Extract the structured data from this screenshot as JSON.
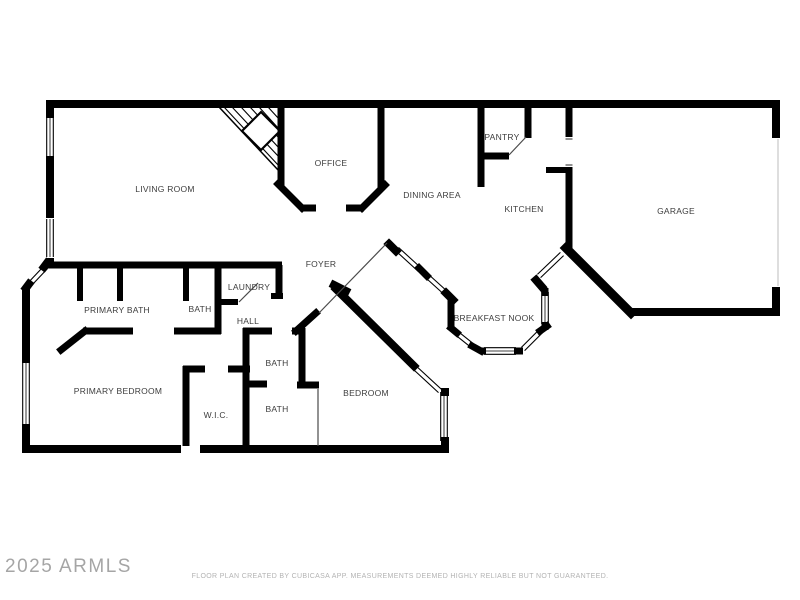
{
  "page": {
    "background": "#ffffff"
  },
  "colors": {
    "walls": "#000000",
    "labels": "#3d3d3d",
    "watermark": "#9c9c9c",
    "footer": "#b3b3b3"
  },
  "watermark": {
    "text": "2025 ARMLS"
  },
  "footer": {
    "text": "FLOOR PLAN CREATED BY CUBICASA APP. MEASUREMENTS DEEMED HIGHLY RELIABLE BUT NOT GUARANTEED."
  },
  "floor_plan": {
    "rooms": [
      {
        "id": "living-room",
        "label": "LIVING ROOM",
        "x": 165,
        "y": 189
      },
      {
        "id": "office",
        "label": "OFFICE",
        "x": 331,
        "y": 163
      },
      {
        "id": "pantry",
        "label": "PANTRY",
        "x": 502,
        "y": 137
      },
      {
        "id": "dining-area",
        "label": "DINING AREA",
        "x": 432,
        "y": 195
      },
      {
        "id": "kitchen",
        "label": "KITCHEN",
        "x": 524,
        "y": 209
      },
      {
        "id": "garage",
        "label": "GARAGE",
        "x": 676,
        "y": 211
      },
      {
        "id": "foyer",
        "label": "FOYER",
        "x": 321,
        "y": 264
      },
      {
        "id": "laundry",
        "label": "LAUNDRY",
        "x": 249,
        "y": 287
      },
      {
        "id": "primary-bath",
        "label": "PRIMARY BATH",
        "x": 117,
        "y": 310
      },
      {
        "id": "bath-middle",
        "label": "BATH",
        "x": 200,
        "y": 309
      },
      {
        "id": "hall",
        "label": "HALL",
        "x": 248,
        "y": 321
      },
      {
        "id": "breakfast-nook",
        "label": "BREAKFAST NOOK",
        "x": 494,
        "y": 318
      },
      {
        "id": "primary-bedroom",
        "label": "PRIMARY BEDROOM",
        "x": 118,
        "y": 391
      },
      {
        "id": "bath-hall",
        "label": "BATH",
        "x": 277,
        "y": 363
      },
      {
        "id": "wic",
        "label": "W.I.C.",
        "x": 216,
        "y": 415
      },
      {
        "id": "bath-lower",
        "label": "BATH",
        "x": 277,
        "y": 409
      },
      {
        "id": "bedroom",
        "label": "BEDROOM",
        "x": 366,
        "y": 393
      }
    ]
  }
}
